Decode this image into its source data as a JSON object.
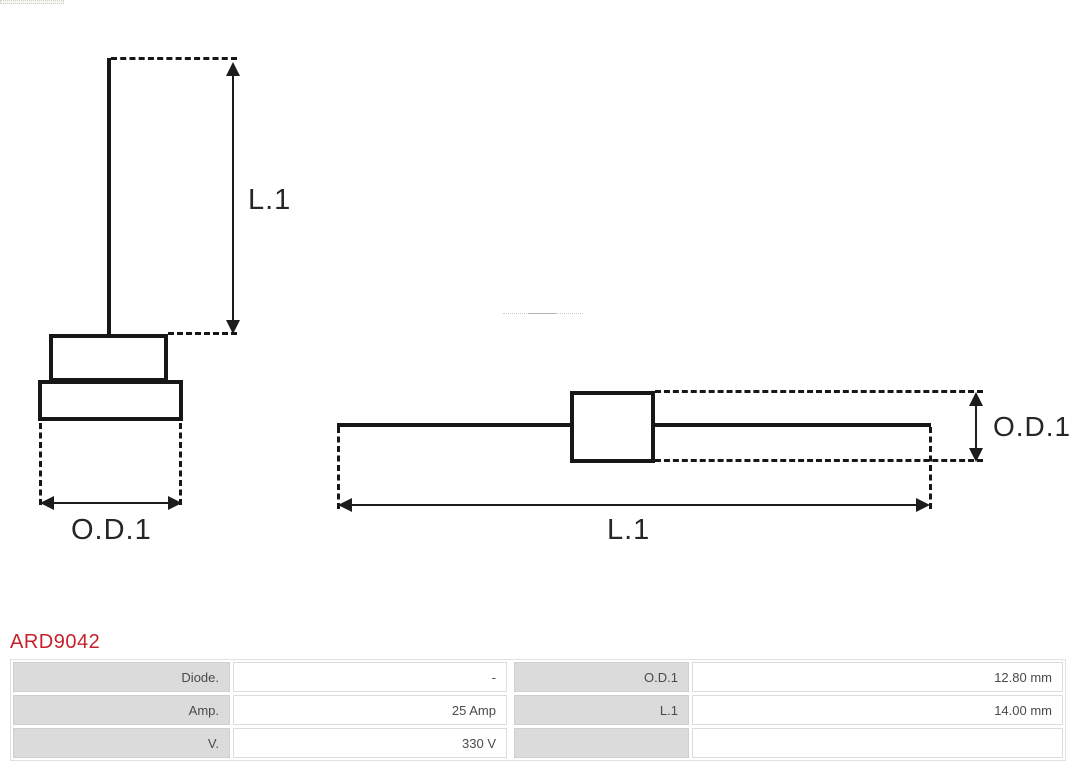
{
  "product": {
    "code": "ARD9042"
  },
  "colors": {
    "accent_red": "#c5232c",
    "label_cell_bg": "#dbdbdb",
    "drawing_ink": "#171717"
  },
  "diagrams": {
    "front_view": {
      "length_label": "L.1",
      "diameter_label": "O.D.1"
    },
    "side_view": {
      "length_label": "L.1",
      "diameter_label": "O.D.1"
    }
  },
  "spec_table": {
    "rows": [
      {
        "c1": "Diode.",
        "c2": "-",
        "c3": "O.D.1",
        "c4": "12.80 mm"
      },
      {
        "c1": "Amp.",
        "c2": "25 Amp",
        "c3": "L.1",
        "c4": "14.00 mm"
      },
      {
        "c1": "V.",
        "c2": "330 V",
        "c3": "",
        "c4": ""
      }
    ]
  }
}
